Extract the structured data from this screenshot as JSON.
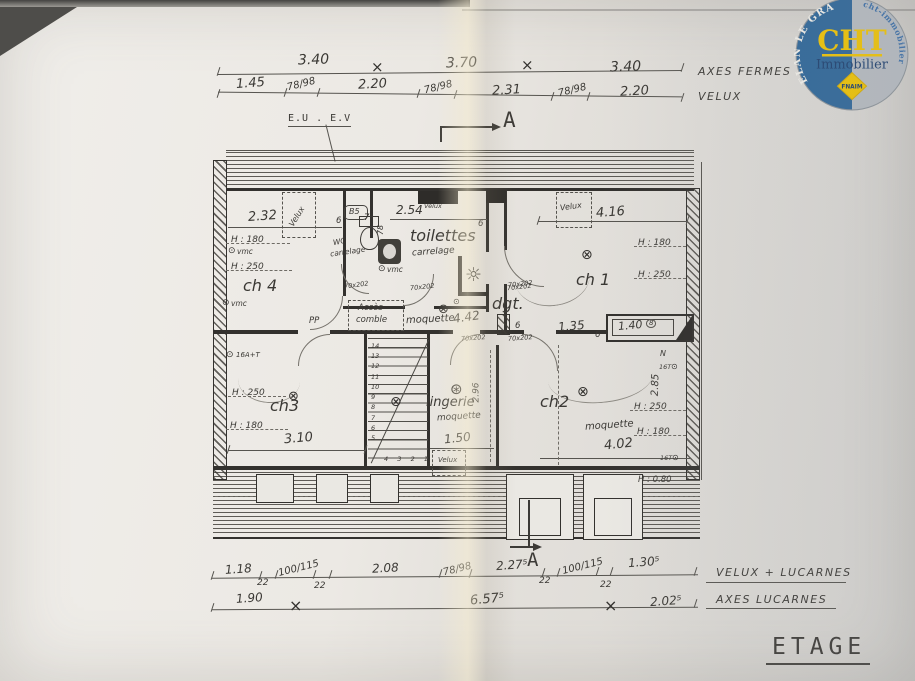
{
  "title": "ETAGE",
  "logo": {
    "arc_left": "PLELAN LE GRAND",
    "arc_right": "www.cht-immobilier.com",
    "brand": "CHT",
    "subtitle": "Immobilier",
    "badge": "FNAIM",
    "blue": "#2d6699",
    "yellow": "#f2c500",
    "gray": "#b7bcc1"
  },
  "top_dims": {
    "row1": [
      "3.40",
      "3.70",
      "3.40"
    ],
    "row1_label": "AXES FERMES",
    "row2": [
      "1.45",
      "78/98",
      "2.20",
      "78/98",
      "2.31",
      "78/98",
      "2.20"
    ],
    "row2_label": "VELUX"
  },
  "bottom_dims": {
    "row1": [
      "1.18",
      "22",
      "100/115",
      "22",
      "2.08",
      "78/98",
      "2.27⁵",
      "22",
      "100/115",
      "22",
      "1.30⁵"
    ],
    "row1_label": "VELUX + LUCARNES",
    "row2": [
      "1.90",
      "6.57⁵",
      "2.02⁵"
    ],
    "row2_label": "AXES LUCARNES"
  },
  "annotations": {
    "eu_ev": "E.U . E.V",
    "section": "A",
    "pp": "PP",
    "acces_l1": "Accès",
    "acces_l2": "comble",
    "north": "N"
  },
  "rooms": {
    "ch4": {
      "name": "ch 4",
      "width": "2.32",
      "velux": "Velux",
      "h1": "H : 180",
      "h2": "H : 250",
      "vmc": "vmc",
      "tag": "6"
    },
    "toilettes": {
      "name": "toilettes",
      "floor": "carrelage",
      "width": "2.54",
      "velux_w": "78",
      "velux": "Velux",
      "b5": "B5",
      "wc_l1": "WC",
      "wc_l2": "carrelage",
      "vmc": "vmc",
      "door_a": "70x202",
      "door_b": "70x202",
      "tag7": "7",
      "tag6": "6"
    },
    "ch1": {
      "name": "ch 1",
      "width": "4.16",
      "velux": "Velux",
      "h1": "H : 180",
      "h2": "H : 250",
      "door": "70x202",
      "d135": "1.35",
      "tag6": "6"
    },
    "dgt": {
      "name": "dgt.",
      "floor": "moquette",
      "length": "4.42",
      "doors": [
        "70x202",
        "70x202",
        "70x202"
      ]
    },
    "ch3": {
      "name": "ch3",
      "outlet": "16A+T",
      "h2": "H : 250",
      "h1": "H : 180",
      "width": "3.10"
    },
    "stairs": {
      "steps": [
        "14",
        "13",
        "12",
        "11",
        "10",
        "9",
        "8",
        "7",
        "6",
        "5"
      ],
      "steps_bottom": [
        "4",
        "3",
        "2",
        "1"
      ]
    },
    "lingerie": {
      "name": "lingerie",
      "floor": "moquette",
      "width": "1.50",
      "depth": "2.96",
      "velux": "Velux"
    },
    "ch2": {
      "name": "ch2",
      "floor": "moquette",
      "width": "4.02",
      "h2": "H : 250",
      "h1": "H : 180",
      "depth": "2.85",
      "outlet": "16T",
      "outlet2": "16T",
      "sill": "H : 0.80",
      "closet": "1.40",
      "tag8": "8",
      "tag6": "6"
    }
  },
  "symbols": {
    "vmc_icon": "⊙",
    "light_icon": "⊗",
    "fan_icon": "⊛",
    "spot_icon": "☼",
    "axis_mark": "×",
    "outlet_icon": "⊙"
  }
}
